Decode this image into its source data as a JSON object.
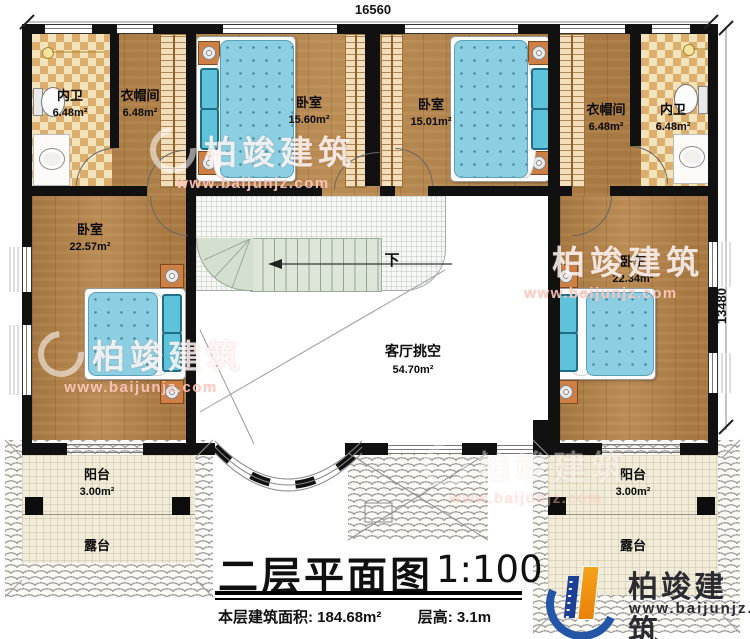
{
  "plan": {
    "dim_top": "16560",
    "dim_right": "13480",
    "stair_down": "下",
    "rooms": [
      {
        "name": "内卫",
        "area": "6.48m²"
      },
      {
        "name": "衣帽间",
        "area": "6.48m²"
      },
      {
        "name": "卧室",
        "area": "15.60m²"
      },
      {
        "name": "卧室",
        "area": "15.01m²"
      },
      {
        "name": "衣帽间",
        "area": "6.48m²"
      },
      {
        "name": "内卫",
        "area": "6.48m²"
      },
      {
        "name": "卧室",
        "area": "22.57m²"
      },
      {
        "name": "卧室",
        "area": "22.34m²"
      },
      {
        "name": "客厅挑空",
        "area": "54.70m²"
      },
      {
        "name": "阳台",
        "area": "3.00m²"
      },
      {
        "name": "阳台",
        "area": "3.00m²"
      },
      {
        "name": "露台"
      },
      {
        "name": "露台"
      }
    ]
  },
  "titleblock": {
    "title": "二层平面图",
    "scale": "1:100",
    "area_text": "本层建筑面积: 184.68m²",
    "height_text": "层高: 3.1m"
  },
  "watermark": {
    "brand": "柏竣建筑",
    "site": "www.baijunjz.com"
  },
  "logo": {
    "brand": "柏竣建筑",
    "site": "www.baijunjz.com"
  },
  "colors": {
    "wall": "#111111",
    "wood": "#b2824a",
    "mattress": "#8ccfe2",
    "stair": "#dde5d8",
    "terrace": "#f1ecd8",
    "logo_blue": "#2456a8",
    "logo_orange": "#f0920e"
  }
}
